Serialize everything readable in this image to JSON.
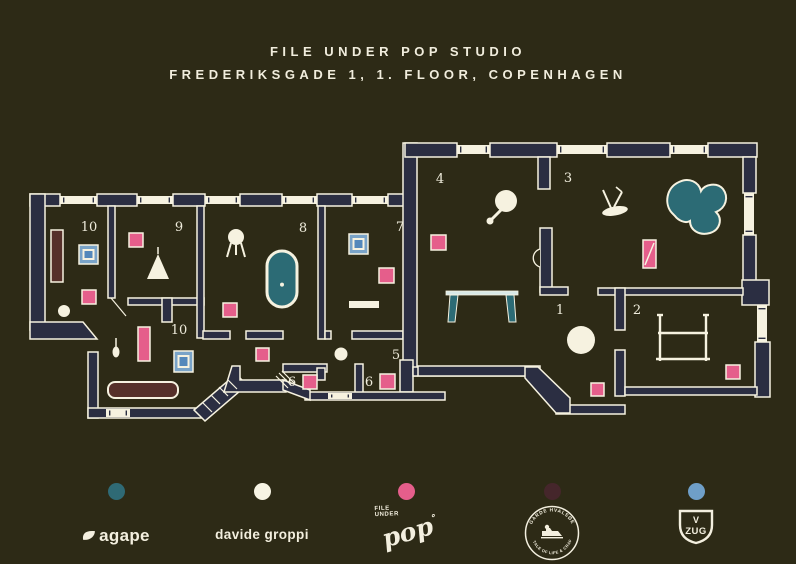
{
  "title": {
    "line1": "FILE UNDER POP STUDIO",
    "line2": "FREDERIKSGADE 1, 1. FLOOR, COPENHAGEN"
  },
  "colors": {
    "background": "#2d2a16",
    "wall": "#2b2e42",
    "cream": "#f6f2e0",
    "pink": "#e55e8b",
    "teal": "#2c6b75",
    "maroon": "#56302a",
    "steel_blue": "#79a3c8",
    "screen_blue": "#5488bb",
    "pale_table": "#d9e9e7",
    "garde_maroon": "#45262b",
    "vzug_blue": "#6f9fc8"
  },
  "floorplan": {
    "room_labels": [
      {
        "text": "10",
        "x": 89,
        "y": 231
      },
      {
        "text": "9",
        "x": 179,
        "y": 231
      },
      {
        "text": "8",
        "x": 303,
        "y": 232
      },
      {
        "text": "7",
        "x": 400,
        "y": 231
      },
      {
        "text": "4",
        "x": 440,
        "y": 183
      },
      {
        "text": "3",
        "x": 568,
        "y": 182
      },
      {
        "text": "10",
        "x": 179,
        "y": 334
      },
      {
        "text": "5",
        "x": 396,
        "y": 359
      },
      {
        "text": "6",
        "x": 292,
        "y": 386
      },
      {
        "text": "6",
        "x": 369,
        "y": 386
      },
      {
        "text": "1",
        "x": 560,
        "y": 314
      },
      {
        "text": "2",
        "x": 637,
        "y": 314
      }
    ],
    "markers": [
      {
        "x": 82,
        "y": 290,
        "s": 14
      },
      {
        "x": 129,
        "y": 233,
        "s": 14
      },
      {
        "x": 223,
        "y": 303,
        "s": 14
      },
      {
        "x": 379,
        "y": 268,
        "s": 15
      },
      {
        "x": 431,
        "y": 235,
        "s": 15
      },
      {
        "x": 256,
        "y": 348,
        "s": 13
      },
      {
        "x": 303,
        "y": 375,
        "s": 14
      },
      {
        "x": 380,
        "y": 374,
        "s": 15
      },
      {
        "x": 591,
        "y": 383,
        "s": 13
      },
      {
        "x": 726,
        "y": 365,
        "s": 14
      }
    ],
    "furniture": [
      {
        "type": "cabinet",
        "x": 51,
        "y": 230,
        "w": 12,
        "h": 52
      },
      {
        "type": "appliance",
        "x": 79,
        "y": 245,
        "w": 19,
        "h": 19
      },
      {
        "type": "dot",
        "cx": 64,
        "cy": 311,
        "r": 6
      },
      {
        "type": "triangle-lamp",
        "cx": 158,
        "baseY": 279,
        "tipY": 254,
        "half": 11
      },
      {
        "type": "tripod-lamp",
        "cx": 236,
        "cy": 237,
        "r": 8
      },
      {
        "type": "bathtub",
        "x": 267,
        "y": 251,
        "w": 30,
        "h": 56
      },
      {
        "type": "appliance",
        "x": 349,
        "y": 234,
        "w": 19,
        "h": 20
      },
      {
        "type": "shelf",
        "x": 349,
        "y": 301,
        "w": 30,
        "h": 7
      },
      {
        "type": "mirror",
        "cx": 506,
        "cy": 201,
        "r": 11,
        "hx": 491,
        "hy": 220
      },
      {
        "type": "table",
        "x": 446,
        "y": 291,
        "w": 72,
        "h": 32
      },
      {
        "type": "sprout",
        "cx": 615,
        "cy": 211
      },
      {
        "type": "blob",
        "cx": 695,
        "cy": 205
      },
      {
        "type": "slashrect",
        "x": 643,
        "y": 240,
        "w": 13,
        "h": 28
      },
      {
        "type": "dot",
        "cx": 581,
        "cy": 340,
        "r": 14
      },
      {
        "type": "rack",
        "x": 660,
        "y": 315
      },
      {
        "type": "pinkrect",
        "x": 138,
        "y": 327,
        "w": 12,
        "h": 34
      },
      {
        "type": "pendant",
        "cx": 116,
        "cy": 344
      },
      {
        "type": "appliance",
        "x": 174,
        "y": 351,
        "w": 19,
        "h": 21
      },
      {
        "type": "sofa",
        "x": 108,
        "y": 382,
        "w": 70,
        "h": 16
      },
      {
        "type": "dot",
        "cx": 341,
        "cy": 354,
        "r": 6.5
      }
    ]
  },
  "legend": {
    "items": [
      {
        "id": "agape",
        "dot_color": "#2f6a75",
        "label": "agape"
      },
      {
        "id": "davide-groppi",
        "dot_color": "#f7f4e4",
        "label": "davide groppi"
      },
      {
        "id": "file-under-pop",
        "dot_color": "#e55e8b",
        "small_line1": "FILE",
        "small_line2": "UNDER",
        "big": "pop",
        "mark": "˚"
      },
      {
        "id": "garde-hvalsoe",
        "dot_color": "#45262b",
        "arc_top": "GARDE HVALSØE",
        "arc_bottom": "A TALE OF LIFE & CRAFT"
      },
      {
        "id": "v-zug",
        "dot_color": "#6f9fc8",
        "v": "V",
        "zug": "ZUG"
      }
    ]
  }
}
